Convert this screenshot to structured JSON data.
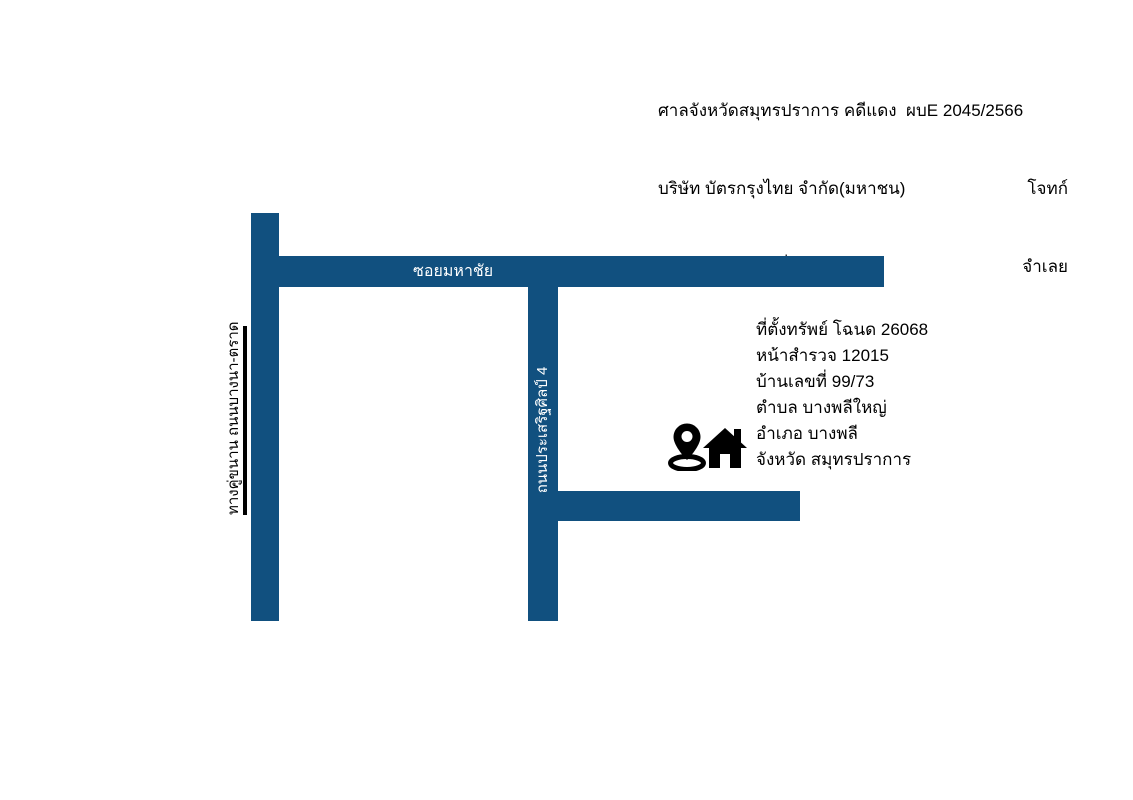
{
  "header": {
    "case_line": "ศาลจังหวัดสมุทรปราการ คดีแดง  ผบE 2045/2566",
    "plaintiff": {
      "name": "บริษัท บัตรกรุงไทย จำกัด(มหาชน)",
      "role": "โจทก์"
    },
    "defendant": {
      "name": "นางสาวสิริภรณ์ มิ่งรัตนสิริกุล",
      "role": "จำเลย"
    }
  },
  "map": {
    "road_color": "#11507F",
    "roads": {
      "frontage": {
        "label": "ทางคู่ขนาน ถนนบางนา-ตราด"
      },
      "soi": {
        "label": "ซอยมหาชัย"
      },
      "prasert": {
        "label": "ถนนประเสริฐศิลป์ 4"
      },
      "branch": {
        "label": ""
      }
    },
    "icons": {
      "pin": "location-pin",
      "house": "house"
    },
    "property": {
      "lines": [
        "ที่ตั้งทรัพย์ โฉนด 26068",
        "หน้าสำรวจ 12015",
        "บ้านเลขที่ 99/73",
        "ตำบล บางพลีใหญ่",
        "อำเภอ บางพลี",
        "จังหวัด สมุทรปราการ"
      ]
    }
  }
}
